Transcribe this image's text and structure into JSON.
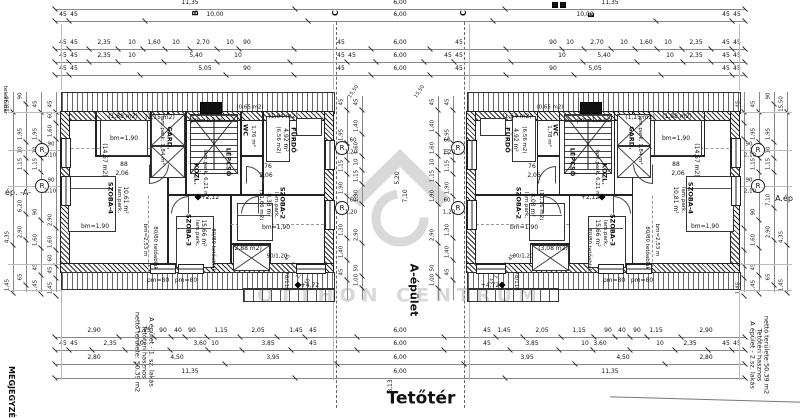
{
  "titles": {
    "floor": "Tetőtér",
    "building_axis": "A-épület",
    "note_heading": "MEGJEGYZÉ",
    "boundary": "telekhatár",
    "left_edge_label": "ép. -A-",
    "right_edge_label": "A.ép",
    "watermark": "OTTHON CENTRUM"
  },
  "area_notes": {
    "left": [
      "A épület - 1. sz. lakás",
      "Tetőtéri hasznos",
      "nettó területe: 50,39 m2"
    ],
    "right": [
      "A épület - 2.sz. lakás",
      "Tetőtéri hasznos",
      "nettó területe:50,39 m2"
    ]
  },
  "markers": {
    "b": "B",
    "c1": "C",
    "c2": "C",
    "e": "E",
    "r": "R"
  },
  "rooms": {
    "left": {
      "a188": "(1,88 m2)",
      "bm190a": "bm=1,90",
      "g1457": "(14,57 m2)",
      "a115": "(1,15 m2)",
      "gardp": "lam.park, 1,84 m²",
      "gard": "GARD.",
      "pm14": "pm=1,4 m",
      "wc": "WC",
      "wcm": "1,76 m²",
      "a065": "(0,65 m2)",
      "a164": "(1,64 m2)",
      "furdog": "(6,56 m2)",
      "furdom": "4,92 m²",
      "furdo": "FÜRDŐ",
      "d76": "76",
      "d76m": "2,06",
      "d88": "88",
      "d88m": "2,06",
      "kozl": "KÖZL.",
      "kozlp": "lam.park, 6,21 m²",
      "lepcso": "LÉPCSŐ",
      "sz4": "SZOBA-4",
      "sz4p": "lam.park,",
      "sz4m": "10,61 m²",
      "bm190b": "bm=1,90",
      "bm253": "bm=2,53 m",
      "tab1": "80/80 tetőablak",
      "tab2": "80/80 tetőablak",
      "sz3": "SZOBA-3",
      "sz3p": "lam.park,",
      "sz3m": "15,66 m²",
      "sz2": "SZOBA-2",
      "sz2p": "lam.park,",
      "sz2m": "8,38 m²",
      "sz2g": "(11,66 m2)",
      "bm190c": "bm=1,90",
      "a288": "(2,88 m2)",
      "w90120": "90/1,20",
      "pm80a": "pm=80",
      "pm80b": "pm=80",
      "r78118": "78/118",
      "lvl_mid": "+2,12",
      "lvl_bot": "+4,72",
      "win1a": "90",
      "win1b": "2,10",
      "win2a": "90",
      "win2b": "2,10",
      "gap1a": "60",
      "gap1b": "1,20",
      "gap2a": "60",
      "gap2b": "1,20"
    },
    "right": {
      "a188": "(1,88 m2)",
      "bm190a": "bm=1,90",
      "g1457": "(14,57 m2)",
      "a115": "(1,15 m2)",
      "gardp": "lam.park, 1,84 m²",
      "gard": "GARD.",
      "pm14": "pm=1,4 m",
      "wc": "WC",
      "wcm": "1,78 m²",
      "a065": "(0,65 m2)",
      "a164": "(1,64 m2)",
      "furdog": "(6,56 m2)",
      "furdom": "4,92 m²",
      "furdo": "FÜRDŐ",
      "d76": "76",
      "d76m": "2,06",
      "d88": "88",
      "d88m": "2,06",
      "kozl": "KÖZL.",
      "kozlp": "lam.park, 6,21 m²",
      "lepcso": "LÉPCSŐ",
      "sz4": "SZOBA-4",
      "sz4p": "lam.park,",
      "sz4m": "10,81 m²",
      "bm190b": "bm=1,90",
      "bm253": "bm=2,53 m",
      "tab1": "80/80 tetőablak",
      "tab2": "80/80 tetőablak",
      "sz3": "SZOBA-3",
      "sz3p": "lam.park,",
      "sz3m": "15,66 m²",
      "sz2": "SZOBA-2",
      "sz2p": "lam.park,",
      "sz2m": "8,08 m²",
      "sz2g": "(11,16 m2)",
      "bm190c": "bm=1,90",
      "a288": "(3,08 m2)",
      "w90120": "90/1,20",
      "pm80a": "pm=80",
      "pm80b": "pm=80",
      "r78118": "78/118",
      "lvl_mid": "+2,12",
      "lvl_bot": "+4,72",
      "win1a": "90",
      "win1b": "2,10",
      "win2a": "90",
      "win2b": "2,10",
      "gap1a": "60",
      "gap1b": "1,20",
      "gap2a": "60",
      "gap2b": "1,20"
    }
  },
  "dims": {
    "t1": [
      "11,35",
      "6,00",
      "11,35"
    ],
    "t2": [
      "45",
      "45",
      "10,00",
      "6,00",
      "10,00",
      "45",
      "45"
    ],
    "t3": [
      "45",
      "45",
      "2,35",
      "10",
      "1,60",
      "10",
      "2,70",
      "10",
      "90",
      "45",
      "6,00",
      "45",
      "90",
      "10",
      "2,70",
      "10",
      "1,60",
      "10",
      "2,35",
      "45",
      "45"
    ],
    "t4": [
      "45",
      "45",
      "2,35",
      "10",
      "5,40",
      "10",
      "45",
      "45",
      "6,00",
      "45",
      "45",
      "10",
      "5,40",
      "10",
      "2,35",
      "45",
      "45"
    ],
    "t5": [
      "45",
      "45",
      "5,05",
      "90",
      "45",
      "6,00",
      "45",
      "90",
      "5,05",
      "45",
      "45"
    ],
    "b1": [
      "2,90",
      "1,15",
      "90",
      "40",
      "90",
      "1,15",
      "2,05",
      "1,45",
      "45",
      "6,00",
      "45",
      "1,45",
      "2,05",
      "1,15",
      "90",
      "40",
      "90",
      "1,15",
      "2,90"
    ],
    "b2": [
      "45",
      "45",
      "2,35",
      "10",
      "3,60",
      "10",
      "3,85",
      "45",
      "6,00",
      "45",
      "3,85",
      "10",
      "3,60",
      "10",
      "2,35",
      "45",
      "45"
    ],
    "b3": [
      "2,80",
      "4,50",
      "3,95",
      "6,00",
      "3,95",
      "4,50",
      "2,80"
    ],
    "b4": [
      "11,35",
      "6,00",
      "11,35"
    ],
    "b5": "8,13",
    "le0": [
      "15,50",
      "4,35",
      "1,45"
    ],
    "le1": [
      "90",
      "1,95",
      "10",
      "1,15",
      "6,20",
      "2,90",
      "65"
    ],
    "le2": [
      "45",
      "1,95",
      "10",
      "1,15",
      "90",
      "1,60",
      "45",
      "1,45"
    ],
    "le3": [
      "45",
      "60",
      "1,60",
      "2,90",
      "1,60",
      "60",
      "45",
      "1,45"
    ],
    "re0": [
      "15,50",
      "4,35",
      "1,45"
    ],
    "re1": [
      "90",
      "1,95",
      "10",
      "1,15",
      "7,10",
      "2,90",
      "65"
    ],
    "re2": [
      "45",
      "1,95",
      "10",
      "1,15",
      "90",
      "1,60",
      "45",
      "1,45"
    ],
    "re3": [
      "45",
      "60",
      "1,60",
      "2,90",
      "1,60",
      "60",
      "45",
      "1,45"
    ],
    "cc0": [
      "45",
      "1,95",
      "10",
      "1,15",
      "1,90",
      "1,30",
      "1,40",
      "45"
    ],
    "cc1": [
      "45",
      "1,40",
      "1,60",
      "10",
      "1,15",
      "1,90",
      "2,90",
      "50",
      "1,00"
    ],
    "cc2": [
      "45",
      "1,40",
      "1,60",
      "10",
      "1,15",
      "1,90",
      "2,90",
      "50",
      "1,00"
    ],
    "cc3": [
      "45",
      "1,95",
      "10",
      "1,15",
      "1,90",
      "1,30",
      "1,40",
      "45"
    ],
    "mid": [
      "5,20",
      "7,10"
    ],
    "tilt": [
      "15,50",
      "15,50",
      "45",
      "50",
      "1,00",
      "15",
      "45",
      "50",
      "1,00",
      "15"
    ]
  }
}
